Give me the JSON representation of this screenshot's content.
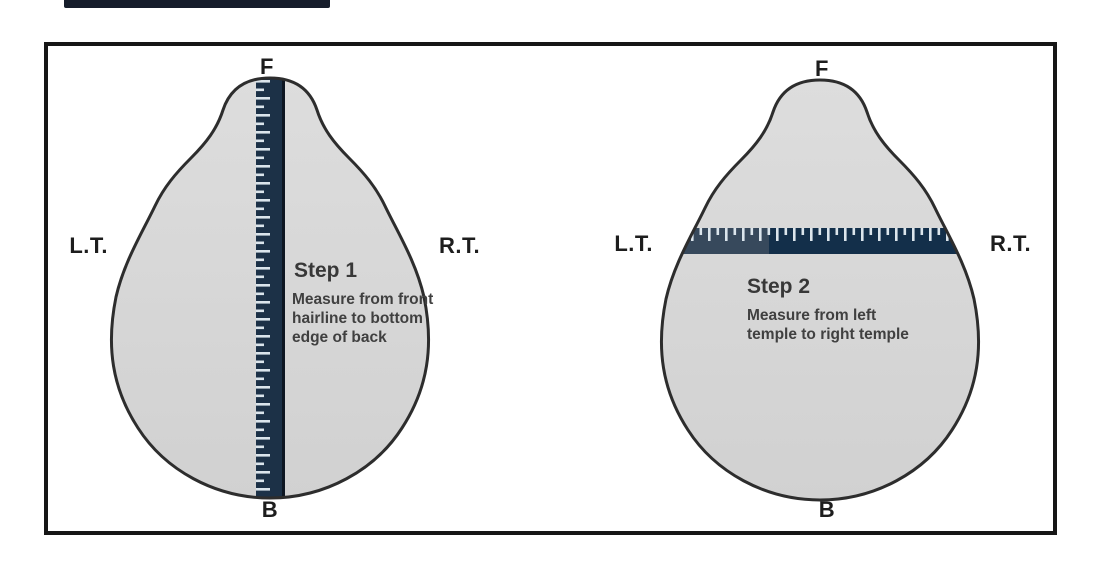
{
  "canvas": {
    "background": "#ffffff"
  },
  "top_bar": {
    "color": "#161d2b"
  },
  "colors": {
    "head_fill": "#d7d7d7",
    "head_outline": "#2d2d2d",
    "ruler_navy": "#1c3147",
    "ruler_navy_light": "#37495c",
    "ruler_navy_dark": "#132f4a",
    "tick_color": "#dbe5ec",
    "frame_border": "#161616",
    "label_text": "#1d1d1d",
    "instruction_text": "#404040"
  },
  "steps": [
    {
      "title": "Step 1",
      "ruler_orientation": "vertical",
      "labels": {
        "front": "F",
        "back": "B",
        "left_temple": "L.T.",
        "right_temple": "R.T."
      },
      "instruction_lines": [
        "Measure from front",
        "hairline to bottom",
        "edge of back"
      ]
    },
    {
      "title": "Step 2",
      "ruler_orientation": "horizontal",
      "labels": {
        "front": "F",
        "back": "B",
        "left_temple": "L.T.",
        "right_temple": "R.T."
      },
      "instruction_lines": [
        "Measure from left",
        "temple to right temple"
      ]
    }
  ]
}
